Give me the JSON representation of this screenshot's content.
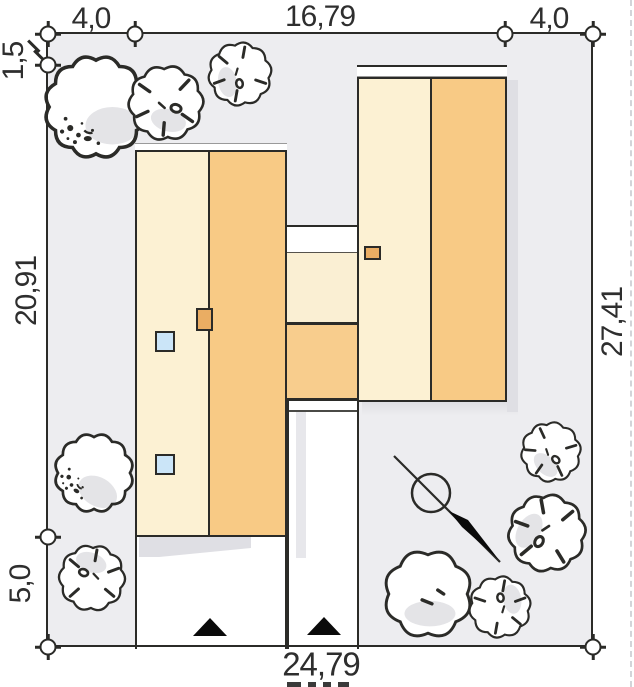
{
  "title": "Building plot site plan",
  "dimensions": {
    "top": [
      "4,0",
      "16,79",
      "4,0"
    ],
    "left": [
      "1,5",
      "20,91",
      "5,0"
    ],
    "right": [
      "27,41"
    ],
    "bottom": [
      "24,79"
    ]
  },
  "colors": {
    "lot_fill": "#EDEDF0",
    "outline": "#2B2B28",
    "roof_cream": "#FCF1D3",
    "roof_orange": "#F8CA85",
    "link_cream": "#FAEFD3",
    "link_orange": "#F8CD8D",
    "chimney": "#EAAD63",
    "skylight": "#CBE5F8",
    "shadow": "#DFDFE4",
    "tree_patch": "#E4E4E7",
    "text": "#2E2E2E"
  },
  "trees": [
    {
      "type": "A",
      "x": 96,
      "y": 107,
      "scale": 1.17,
      "rot": 0
    },
    {
      "type": "B",
      "x": 166,
      "y": 103,
      "scale": 0.85,
      "rot": 15
    },
    {
      "type": "B",
      "x": 240,
      "y": 74,
      "scale": 0.72,
      "rot": 80
    },
    {
      "type": "A",
      "x": 94,
      "y": 473,
      "scale": 0.9,
      "rot": 30
    },
    {
      "type": "B",
      "x": 92,
      "y": 578,
      "scale": 0.75,
      "rot": 200
    },
    {
      "type": "B",
      "x": 551,
      "y": 452,
      "scale": 0.68,
      "rot": 45
    },
    {
      "type": "B",
      "x": 547,
      "y": 533,
      "scale": 0.88,
      "rot": 120
    },
    {
      "type": "C",
      "x": 428,
      "y": 594,
      "scale": 0.98,
      "rot": 0
    },
    {
      "type": "B",
      "x": 500,
      "y": 607,
      "scale": 0.7,
      "rot": 260
    }
  ],
  "north_arrow": {
    "line": {
      "x1": 394,
      "y1": 456,
      "x2": 500,
      "y2": 562
    },
    "circle": {
      "cx": 431,
      "cy": 493,
      "r": 19
    },
    "bolt_points": "449,511 468,520 499,560 462,527"
  },
  "markers": [
    {
      "x": 48,
      "y": 34,
      "ticks": "vh"
    },
    {
      "x": 135,
      "y": 34,
      "ticks": "v"
    },
    {
      "x": 505,
      "y": 34,
      "ticks": "v"
    },
    {
      "x": 593,
      "y": 34,
      "ticks": "vh"
    },
    {
      "x": 48,
      "y": 65,
      "ticks": "h"
    },
    {
      "x": 48,
      "y": 537,
      "ticks": "h"
    },
    {
      "x": 48,
      "y": 647,
      "ticks": "vh"
    },
    {
      "x": 593,
      "y": 647,
      "ticks": "vh"
    }
  ],
  "entrance_arrow_count": 2
}
